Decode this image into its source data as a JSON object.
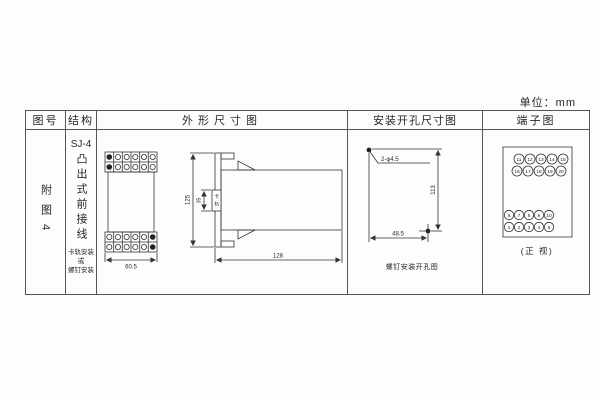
{
  "unit_label": "单位：mm",
  "table": {
    "headers": [
      "图号",
      "结构",
      "外形尺寸图",
      "安装开孔尺寸图",
      "端子图"
    ],
    "row": {
      "figure_no": "附图4",
      "structure": {
        "model": "SJ-4",
        "type": "凸出式前接线",
        "mount_lines": [
          "卡轨安装",
          "或",
          "螺钉安装"
        ]
      }
    }
  },
  "outline_drawing": {
    "front_width": "60.5",
    "height": "125",
    "depth": "128",
    "rail_width": "35",
    "rail_label_chars": [
      "卡",
      "轨"
    ]
  },
  "hole_drawing": {
    "holes_label": "2-φ4.5",
    "vertical_spacing": "113",
    "horizontal_spacing": "48.5",
    "caption": "螺钉安装开孔图"
  },
  "terminal_drawing": {
    "top_rows": [
      [
        "11",
        "12",
        "13",
        "14",
        "15"
      ],
      [
        "16",
        "17",
        "18",
        "19",
        "20"
      ]
    ],
    "bottom_rows": [
      [
        "6",
        "7",
        "8",
        "9",
        "10"
      ],
      [
        "1",
        "2",
        "3",
        "4",
        "5"
      ]
    ],
    "caption": "(正 视)"
  }
}
